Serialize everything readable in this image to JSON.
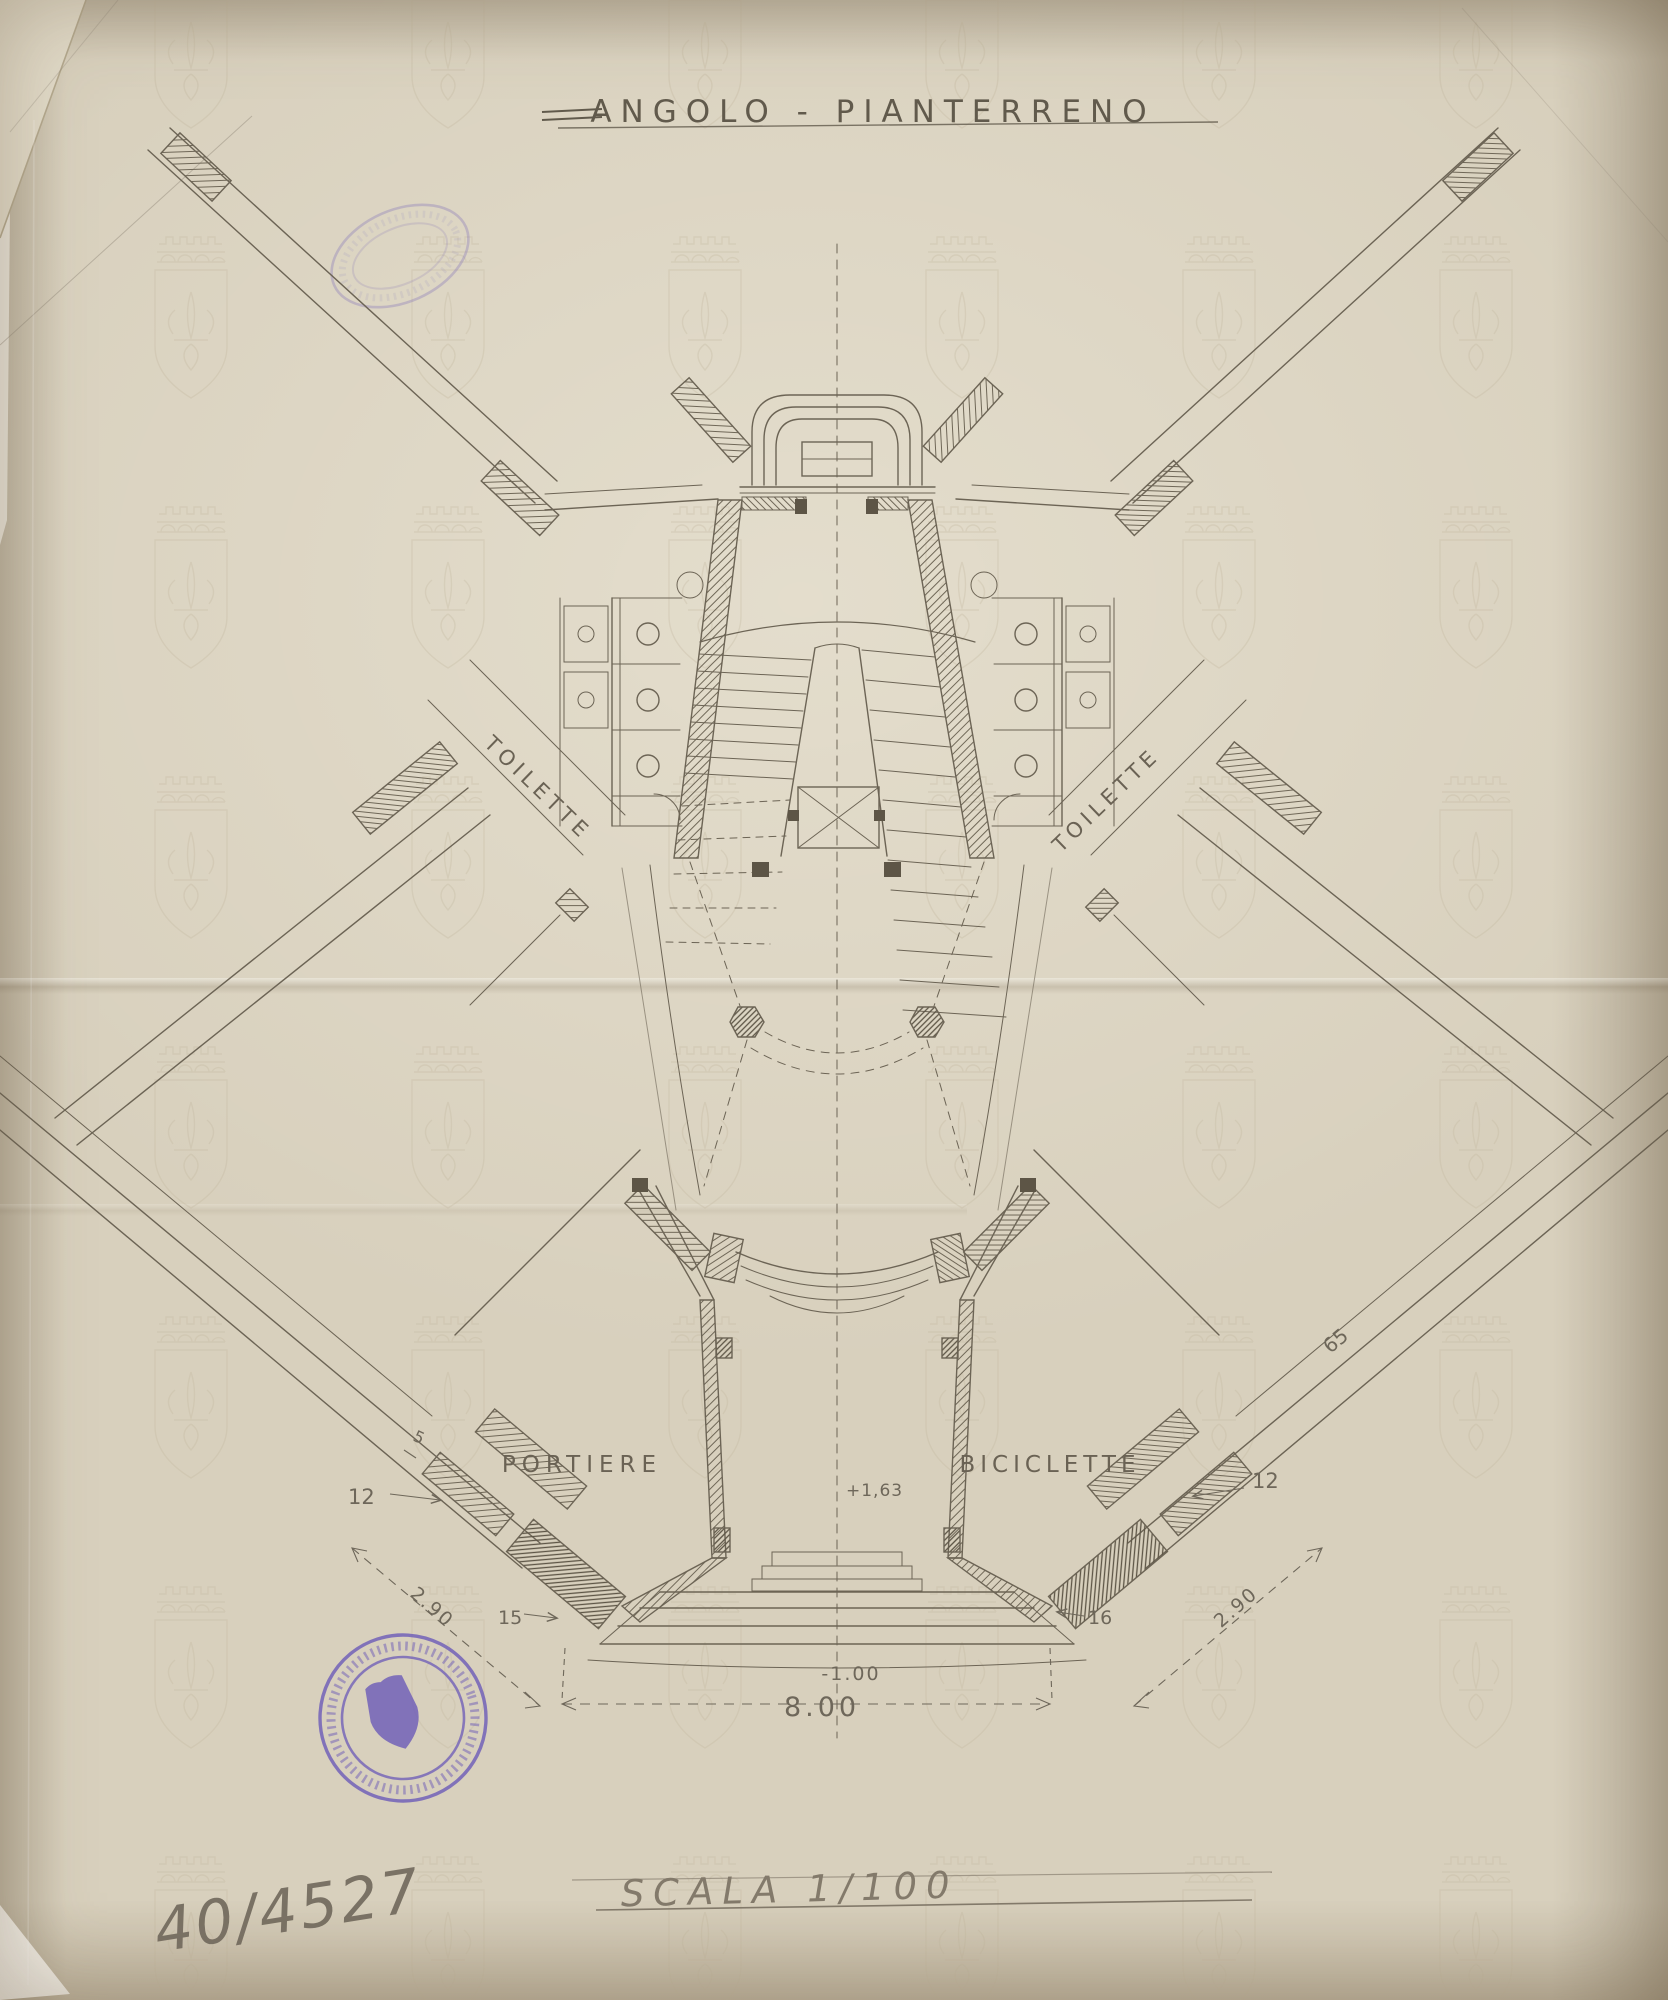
{
  "document": {
    "title": "ANGOLO - PIANTERRENO",
    "scale_note": "SCALA 1/100",
    "archive_number": "40/4527"
  },
  "labels": {
    "toilette_left": "TOILETTE",
    "toilette_right": "TOILETTE",
    "portiere": "PORTIERE",
    "biciclette": "BICICLETTE"
  },
  "dimensions": {
    "total_width": "8.00",
    "level_basement": "-1.00",
    "level_entry": "+1,63",
    "wall_12_left": "12",
    "wall_12_right": "12",
    "tick_15_left": "15",
    "tick_16_right": "16",
    "diag_290_left": "2.90",
    "diag_290_right": "2.90",
    "wall_65": "65",
    "tick_5": "5"
  },
  "colors": {
    "paper": "#d8d0bd",
    "ink": "#6c6455",
    "pencil": "#6e675a",
    "stamp_violet": "#6b5ab8",
    "watermark": "#bfb49a"
  }
}
